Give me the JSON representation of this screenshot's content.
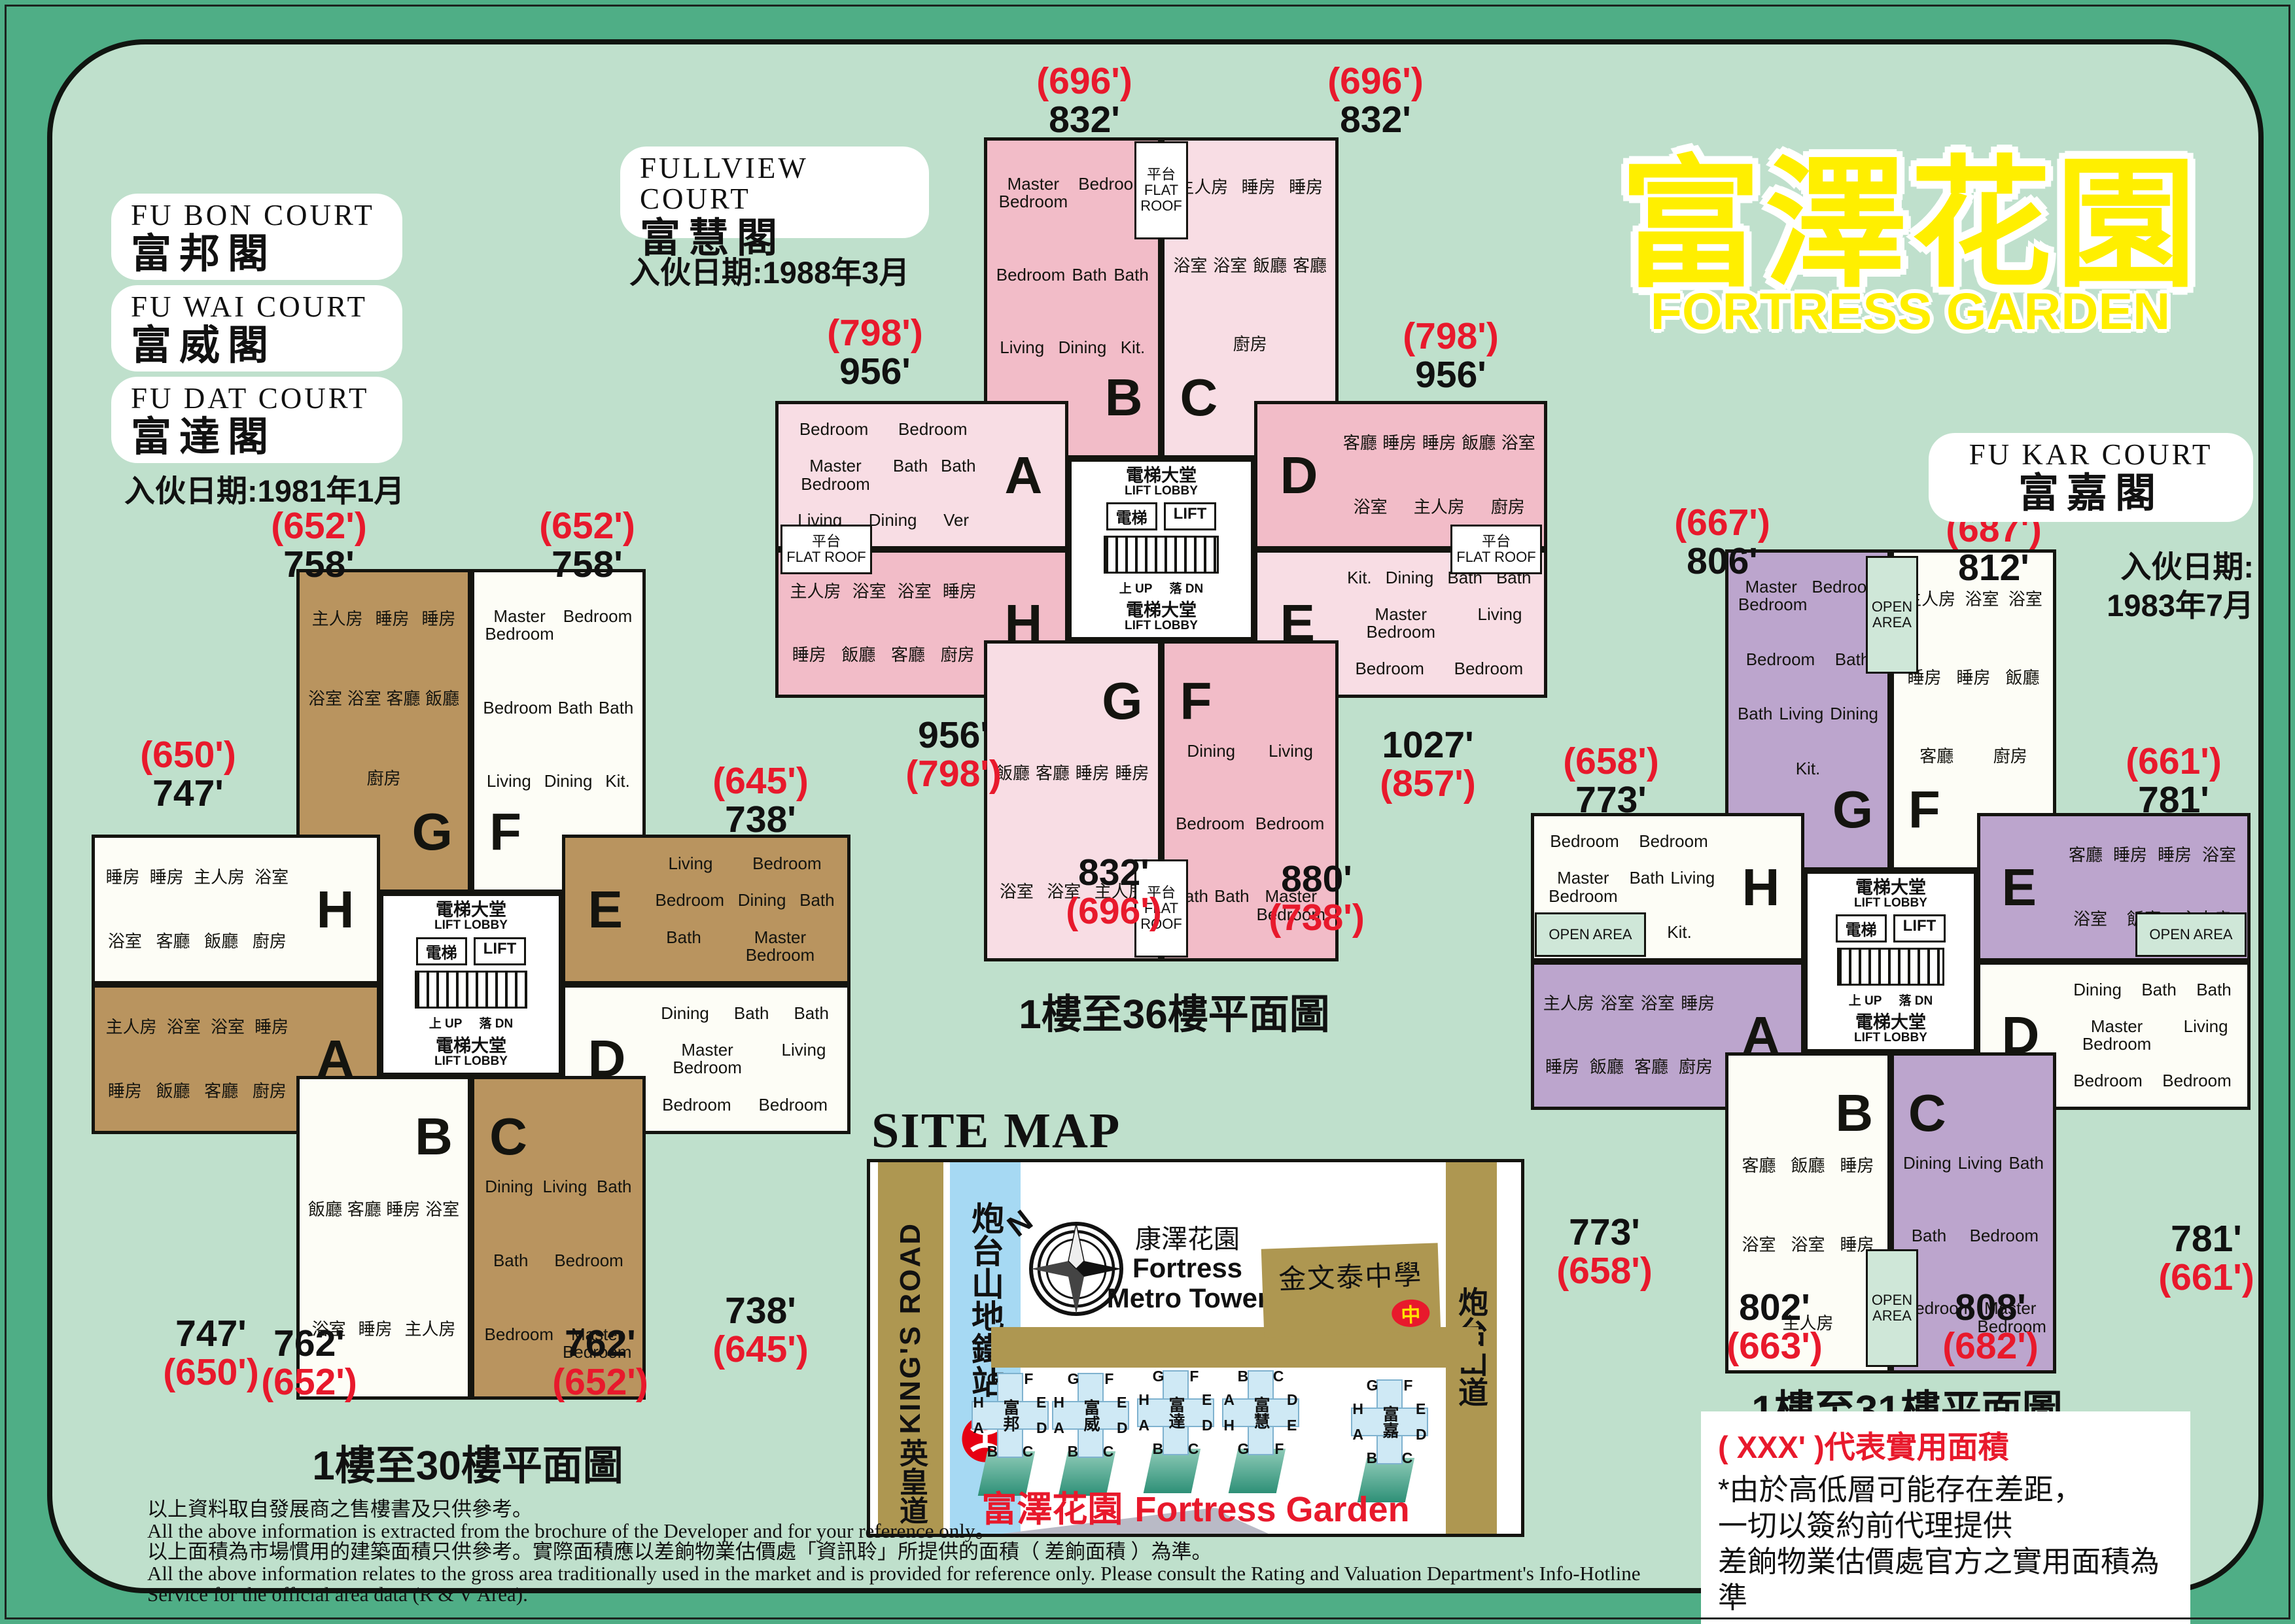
{
  "page": {
    "title_zh": "富澤花園",
    "title_en": "FORTRESS GARDEN",
    "colors": {
      "canvas_green": "#4fae86",
      "panel_green": "#bfe0cc",
      "accent_red": "#e8192c",
      "title_yellow": "#ffef00",
      "wing_brown": "#b9945f",
      "wing_white": "#fdfdf6",
      "wing_pink_dark": "#f2bcc8",
      "wing_pink_light": "#f8dde4",
      "wing_purple": "#bca5cd",
      "open_area_green": "#cfe7d8",
      "map_road_tan": "#ae9751",
      "map_road_blue": "#a6d9f3",
      "map_road_gray": "#b9bac6",
      "tower_blue": "#cfe9f5",
      "mtr_red": "#e60012",
      "school_badge_yellow": "#ffe400"
    }
  },
  "courts_left": {
    "items": [
      {
        "en": "FU BON COURT",
        "zh": "富邦閣"
      },
      {
        "en": "FU WAI COURT",
        "zh": "富威閣"
      },
      {
        "en": "FU DAT COURT",
        "zh": "富達閣"
      }
    ],
    "date": "入伙日期:1981年1月"
  },
  "fullview": {
    "en": "FULLVIEW COURT",
    "zh": "富慧閣",
    "date": "入伙日期:1988年3月"
  },
  "fukar": {
    "en": "FU KAR COURT",
    "zh": "富嘉閣",
    "date_line1": "入伙日期:",
    "date_line2": "1983年7月"
  },
  "plans": [
    {
      "caption": "1樓至30樓平面圖",
      "core": {
        "lobby_zh": "電梯大堂",
        "lobby_en": "LIFT LOBBY",
        "lift_zh": "電梯",
        "lift_en": "LIFT",
        "up": "上 UP",
        "down": "落 DN"
      },
      "wings": {
        "tl": {
          "letter": "G",
          "rooms": [
            "主人房",
            "睡房",
            "睡房",
            "浴室",
            "浴室",
            "客廳",
            "飯廳",
            "廚房"
          ]
        },
        "tr": {
          "letter": "F",
          "rooms": [
            "Master Bedroom",
            "Bedroom",
            "Bedroom",
            "Bath",
            "Bath",
            "Living",
            "Dining",
            "Kit."
          ]
        },
        "lu": {
          "letter": "H",
          "rooms": [
            "睡房",
            "睡房",
            "主人房",
            "浴室",
            "浴室",
            "客廳",
            "飯廳",
            "廚房"
          ]
        },
        "ll": {
          "letter": "A",
          "rooms": [
            "主人房",
            "浴室",
            "浴室",
            "睡房",
            "睡房",
            "飯廳",
            "客廳",
            "廚房"
          ]
        },
        "ru": {
          "letter": "E",
          "rooms": [
            "Living",
            "Bedroom",
            "Bedroom",
            "Dining",
            "Bath",
            "Bath",
            "Master Bedroom"
          ]
        },
        "rl": {
          "letter": "D",
          "rooms": [
            "Dining",
            "Bath",
            "Bath",
            "Master Bedroom",
            "Living",
            "Bedroom",
            "Bedroom"
          ]
        },
        "bl": {
          "letter": "B",
          "rooms": [
            "飯廳",
            "客廳",
            "睡房",
            "浴室",
            "浴室",
            "睡房",
            "主人房"
          ]
        },
        "br": {
          "letter": "C",
          "rooms": [
            "Dining",
            "Living",
            "Bath",
            "Bath",
            "Bedroom",
            "Bedroom",
            "Master Bedroom"
          ]
        }
      },
      "areas": {
        "tl": [
          "(652')",
          "758'"
        ],
        "tr": [
          "(652')",
          "758'"
        ],
        "ul": [
          "(650')",
          "747'"
        ],
        "ur": [
          "(645')",
          "738'"
        ],
        "ml": [
          "747'",
          "(650')"
        ],
        "mr": [
          "738'",
          "(645')"
        ],
        "bl": [
          "762'",
          "(652')"
        ],
        "br": [
          "762'",
          "(652')"
        ]
      }
    },
    {
      "caption": "1樓至36樓平面圖",
      "strip_zh": "平台",
      "strip_en": "FLAT ROOF",
      "core": {
        "lobby_zh": "電梯大堂",
        "lobby_en": "LIFT LOBBY",
        "lift_zh": "電梯",
        "lift_en": "LIFT",
        "up": "上 UP",
        "down": "落 DN"
      },
      "wings": {
        "tl": {
          "letter": "B",
          "rooms": [
            "Master Bedroom",
            "Bedroom",
            "Bedroom",
            "Bath",
            "Bath",
            "Living",
            "Dining",
            "Kit."
          ]
        },
        "tr": {
          "letter": "C",
          "rooms": [
            "主人房",
            "睡房",
            "睡房",
            "浴室",
            "浴室",
            "飯廳",
            "客廳",
            "廚房"
          ]
        },
        "lu": {
          "letter": "A",
          "rooms": [
            "Bedroom",
            "Bedroom",
            "Master Bedroom",
            "Bath",
            "Bath",
            "Living",
            "Dining",
            "Ver"
          ]
        },
        "ll": {
          "letter": "H",
          "rooms": [
            "主人房",
            "浴室",
            "浴室",
            "睡房",
            "睡房",
            "飯廳",
            "客廳",
            "廚房"
          ]
        },
        "ru": {
          "letter": "D",
          "rooms": [
            "客廳",
            "睡房",
            "睡房",
            "飯廳",
            "浴室",
            "浴室",
            "主人房",
            "廚房"
          ]
        },
        "rl": {
          "letter": "E",
          "rooms": [
            "Kit.",
            "Dining",
            "Bath",
            "Bath",
            "Master Bedroom",
            "Living",
            "Bedroom",
            "Bedroom"
          ]
        },
        "bl": {
          "letter": "G",
          "rooms": [
            "飯廳",
            "客廳",
            "睡房",
            "睡房",
            "浴室",
            "浴室",
            "主人房"
          ]
        },
        "br": {
          "letter": "F",
          "rooms": [
            "Dining",
            "Living",
            "Bedroom",
            "Bedroom",
            "Bath",
            "Bath",
            "Master Bedroom"
          ]
        }
      },
      "areas": {
        "tl": [
          "(696')",
          "832'"
        ],
        "tr": [
          "(696')",
          "832'"
        ],
        "ul": [
          "(798')",
          "956'"
        ],
        "ur": [
          "(798')",
          "956'"
        ],
        "ml": [
          "956'",
          "(798')"
        ],
        "mr": [
          "1027'",
          "(857')"
        ],
        "bl": [
          "832'",
          "(696')"
        ],
        "br": [
          "880'",
          "(738')"
        ]
      }
    },
    {
      "caption": "1樓至31樓平面圖",
      "strip": "OPEN AREA",
      "core": {
        "lobby_zh": "電梯大堂",
        "lobby_en": "LIFT LOBBY",
        "lift_zh": "電梯",
        "lift_en": "LIFT",
        "up": "上 UP",
        "down": "落 DN"
      },
      "wings": {
        "tl": {
          "letter": "G",
          "rooms": [
            "Master Bedroom",
            "Bedroom",
            "Bedroom",
            "Bath",
            "Bath",
            "Living",
            "Dining",
            "Kit."
          ]
        },
        "tr": {
          "letter": "F",
          "rooms": [
            "主人房",
            "浴室",
            "浴室",
            "睡房",
            "睡房",
            "飯廳",
            "客廳",
            "廚房"
          ]
        },
        "lu": {
          "letter": "H",
          "rooms": [
            "Bedroom",
            "Bedroom",
            "Master Bedroom",
            "Bath",
            "Living",
            "Dining",
            "Kit."
          ]
        },
        "ll": {
          "letter": "A",
          "rooms": [
            "主人房",
            "浴室",
            "浴室",
            "睡房",
            "睡房",
            "飯廳",
            "客廳",
            "廚房"
          ]
        },
        "ru": {
          "letter": "E",
          "rooms": [
            "客廳",
            "睡房",
            "睡房",
            "浴室",
            "浴室",
            "飯廳",
            "主人房"
          ]
        },
        "rl": {
          "letter": "D",
          "rooms": [
            "Dining",
            "Bath",
            "Bath",
            "Master Bedroom",
            "Living",
            "Bedroom",
            "Bedroom"
          ]
        },
        "bl": {
          "letter": "B",
          "rooms": [
            "客廳",
            "飯廳",
            "睡房",
            "浴室",
            "浴室",
            "睡房",
            "主人房"
          ]
        },
        "br": {
          "letter": "C",
          "rooms": [
            "Dining",
            "Living",
            "Bath",
            "Bath",
            "Bedroom",
            "Bedroom",
            "Master Bedroom"
          ]
        }
      },
      "areas": {
        "tl": [
          "(667')",
          "806'"
        ],
        "tr": [
          "(687')",
          "812'"
        ],
        "ul": [
          "(658')",
          "773'"
        ],
        "ur": [
          "(661')",
          "781'"
        ],
        "ml": [
          "773'",
          "(658')"
        ],
        "mr": [
          "781'",
          "(661')"
        ],
        "bl": [
          "802'",
          "(663')"
        ],
        "br": [
          "808'",
          "(682')"
        ]
      }
    }
  ],
  "site_map": {
    "title": "SITE MAP",
    "kings_road_en": "KING'S ROAD",
    "kings_road_zh": "英皇道",
    "station": "炮台山地鐵站",
    "north": "N",
    "metro_tower_zh": "康澤花園",
    "metro_tower_en1": "Fortress",
    "metro_tower_en2": "Metro Tower",
    "school": "金文泰中學",
    "school_badge": "中",
    "road_right": "炮台山道",
    "caption_zh": "富澤花園",
    "caption_en": "Fortress Garden",
    "towers": [
      {
        "name": "富邦",
        "top": [
          "G",
          "F"
        ],
        "left": [
          "H",
          "A"
        ],
        "right": [
          "E",
          "D"
        ],
        "bottom": [
          "B",
          "C"
        ]
      },
      {
        "name": "富威",
        "top": [
          "G",
          "F"
        ],
        "left": [
          "H",
          "A"
        ],
        "right": [
          "E",
          "D"
        ],
        "bottom": [
          "B",
          "C"
        ]
      },
      {
        "name": "富達",
        "top": [
          "G",
          "F"
        ],
        "left": [
          "H",
          "A"
        ],
        "right": [
          "E",
          "D"
        ],
        "bottom": [
          "B",
          "C"
        ]
      },
      {
        "name": "富慧",
        "top": [
          "B",
          "C"
        ],
        "left": [
          "A",
          "H"
        ],
        "right": [
          "D",
          "E"
        ],
        "bottom": [
          "G",
          "F"
        ]
      },
      {
        "name": "富嘉",
        "top": [
          "G",
          "F"
        ],
        "left": [
          "H",
          "A"
        ],
        "right": [
          "E",
          "D"
        ],
        "bottom": [
          "B",
          "C"
        ]
      }
    ]
  },
  "note_box": {
    "line_red": "( XXX' )代表實用面積",
    "lines": [
      "*由於高低層可能存在差距，",
      "一切以簽約前代理提供",
      "差餉物業估價處官方之實用面積為準"
    ]
  },
  "fine_print": [
    "以上資料取自發展商之售樓書及只供參考。",
    "All the above information is extracted from the brochure of the Developer and for your reference only。",
    "以上面積為市場慣用的建築面積只供參考。實際面積應以差餉物業估價處「資訊聆」所提供的面積（ 差餉面積 ）為準。",
    "All the above information relates to the gross area traditionally used in the market and is provided for reference only. Please consult the Rating and Valuation Department's Info-Hotline Service for the official area data (R & V Area)."
  ]
}
